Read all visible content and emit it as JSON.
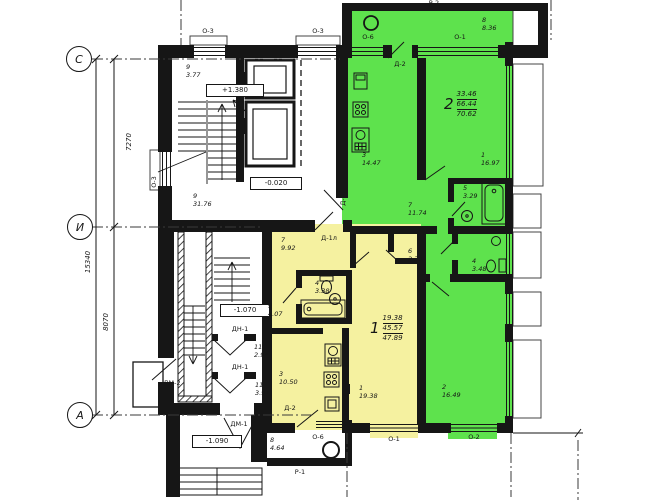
{
  "plan": {
    "axes": {
      "top": "С",
      "middle": "И",
      "bottom": "А"
    },
    "dims": {
      "span_top": "7270",
      "span_bottom": "8070",
      "total": "15340"
    },
    "levels": {
      "stair": "+1.380",
      "floor": "-0.020",
      "basement": "-1.070",
      "entry": "-1.090"
    }
  },
  "apartment2": {
    "number": "2",
    "living": "33.46",
    "total": "66.44",
    "overall": "70.62",
    "rooms": {
      "balcony": {
        "num": "8",
        "area": "8.36"
      },
      "kitchen": {
        "num": "3",
        "area": "14.47"
      },
      "living_room": {
        "num": "1",
        "area": "16.97"
      },
      "hall": {
        "num": "7",
        "area": "11.74"
      },
      "bath": {
        "num": "5",
        "area": "3.29"
      },
      "wc": {
        "num": "4",
        "area": "3.48"
      },
      "bedroom": {
        "num": "2",
        "area": "16.49"
      }
    }
  },
  "apartment1": {
    "number": "1",
    "living": "19.38",
    "total": "45.57",
    "overall": "47.89",
    "rooms": {
      "hall": {
        "num": "7",
        "area": "9.92"
      },
      "bath": {
        "num": "4",
        "area": "3.38"
      },
      "closet": {
        "num": "6",
        "area": "2.39"
      },
      "kitchen": {
        "num": "3",
        "area": "10.50"
      },
      "living_room": {
        "num": "1",
        "area": "19.38"
      }
    }
  },
  "common": {
    "stair_upper": {
      "num": "9",
      "area": "3.77"
    },
    "hall": {
      "num": "9",
      "area": "31.76"
    },
    "stair_lower": {
      "num": "9",
      "area": "4.07"
    },
    "tambour1": {
      "num": "11",
      "area": "2.94"
    },
    "tambour2": {
      "num": "11",
      "area": "3.91"
    },
    "balcony": {
      "num": "8",
      "area": "4.64"
    }
  },
  "openings": {
    "o3": "О-3",
    "o6": "О-6",
    "o1": "О-1",
    "o2": "О-2",
    "d2": "Д-2",
    "d1": "Д-1",
    "d1l": "Д-1л",
    "dn1": "ДН-1",
    "dm1": "ДМ-1",
    "dm2": "ДМ-2",
    "p1": "Р-1",
    "p2": "Р-2"
  },
  "colors": {
    "apartment1_fill": "#f5f1a0",
    "apartment2_fill": "#5ee24d",
    "line": "#161616"
  },
  "icons": [
    "bathtub-icon",
    "toilet-icon",
    "sink-icon",
    "stove-icon",
    "fridge-icon",
    "elevator-icon",
    "stairs-icon",
    "vent-circle-icon"
  ]
}
